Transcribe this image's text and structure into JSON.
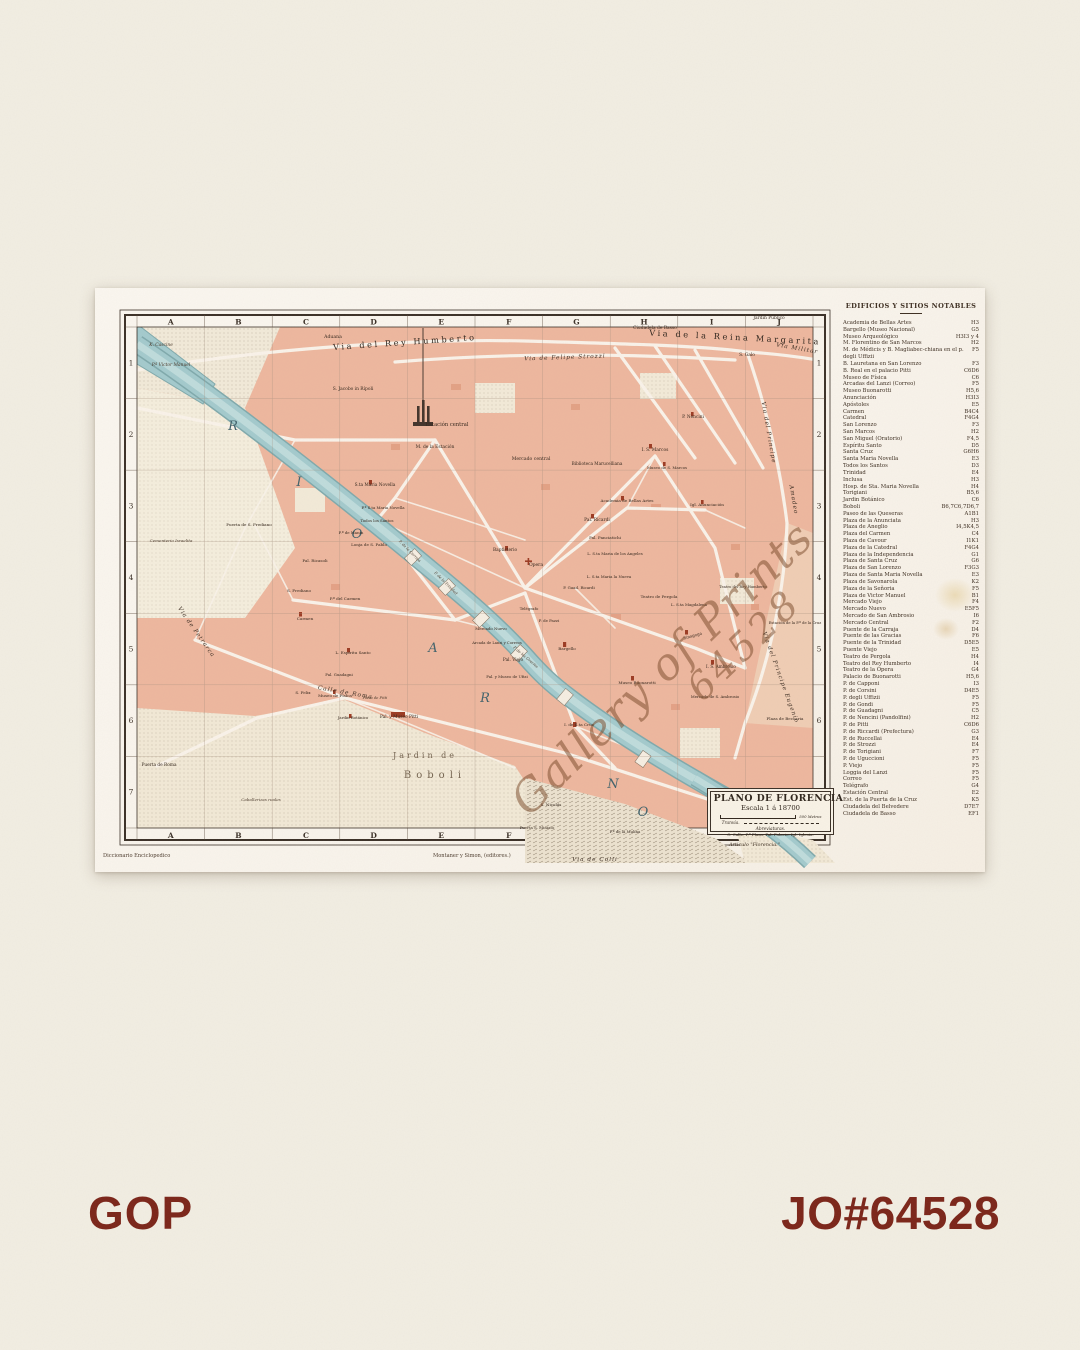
{
  "page": {
    "background_color": "#f2eee3",
    "accent_color": "#7b2418",
    "brand": "GOP",
    "job_number": "JO#64528"
  },
  "map": {
    "title": "PLANO DE FLORENCIA",
    "scale_label": "Escala 1 á 18700",
    "scale_bar_label": "500 Metros",
    "tram_label": "Tranvía.",
    "abbreviations_title": "Abreviaturas.",
    "abbreviations_text": "C. Calle. P.ª Plaza. Pal. Palacio. Igl. Iglesia.",
    "article_note": "Articulo \"Florencia.\"",
    "credits": {
      "left": "Diccionario Enciclopedico",
      "center": "Montaner y Simon, (editores.)"
    },
    "watermark": {
      "line1": "Gallery of Prints",
      "line2": "64528",
      "color": "#79482 8"
    },
    "colors": {
      "city_block": "#eeb79e",
      "block_accent": "#e09a7c",
      "river": "#a3cacd",
      "river_edge": "#7fa9ac",
      "park_cream": "#f3ead8",
      "landmark_red": "#9c3a22",
      "paper": "#faf5ee"
    },
    "grid": {
      "top_columns": [
        "A",
        "B",
        "C",
        "D",
        "E",
        "F",
        "G",
        "H",
        "I",
        "J"
      ],
      "bottom_columns": [
        "A",
        "B",
        "C",
        "D",
        "E",
        "F"
      ],
      "left_rows": [
        "1",
        "2",
        "3",
        "4",
        "5",
        "6",
        "7"
      ],
      "right_rows": [
        "1",
        "2",
        "3",
        "4",
        "5",
        "6",
        "7"
      ]
    },
    "labels": [
      {
        "t": "Via del Rey Humberto",
        "x": 310,
        "y": 57,
        "c": "bst",
        "r": -4
      },
      {
        "t": "Via de la Reina Margarita",
        "x": 640,
        "y": 52,
        "c": "bst",
        "r": 3
      },
      {
        "t": "Via de Felipe Strozzi",
        "x": 470,
        "y": 71,
        "c": "st",
        "r": -2
      },
      {
        "t": "Via Militar",
        "x": 702,
        "y": 62,
        "c": "st",
        "r": 10
      },
      {
        "t": "Via del Principe",
        "x": 672,
        "y": 145,
        "c": "st",
        "r": 80
      },
      {
        "t": "Amadeo",
        "x": 697,
        "y": 212,
        "c": "st",
        "r": 80
      },
      {
        "t": "Via del Principe Eugenio",
        "x": 684,
        "y": 390,
        "c": "st",
        "r": 70
      },
      {
        "t": "Via de Petrarca",
        "x": 100,
        "y": 345,
        "c": "st",
        "r": 55
      },
      {
        "t": "Calle de Roma",
        "x": 250,
        "y": 406,
        "c": "st",
        "r": 10
      },
      {
        "t": "Via de Colli",
        "x": 500,
        "y": 573,
        "c": "st"
      },
      {
        "t": "R",
        "x": 138,
        "y": 142,
        "c": "riv"
      },
      {
        "t": "I",
        "x": 204,
        "y": 198,
        "c": "riv"
      },
      {
        "t": "O",
        "x": 262,
        "y": 250,
        "c": "riv"
      },
      {
        "t": "A",
        "x": 338,
        "y": 364,
        "c": "riv"
      },
      {
        "t": "R",
        "x": 390,
        "y": 414,
        "c": "riv"
      },
      {
        "t": "N",
        "x": 518,
        "y": 500,
        "c": "riv"
      },
      {
        "t": "O",
        "x": 548,
        "y": 528,
        "c": "riv"
      },
      {
        "t": "Jardin de",
        "x": 330,
        "y": 470,
        "c": "ar"
      },
      {
        "t": "Boboli",
        "x": 340,
        "y": 490,
        "c": "ar2"
      },
      {
        "t": "K. Cascine",
        "x": 66,
        "y": 58,
        "c": "pli"
      },
      {
        "t": "P.ª Victor Manuel",
        "x": 76,
        "y": 78,
        "c": "pli",
        "s": 4.4
      },
      {
        "t": "Aduana",
        "x": 238,
        "y": 50,
        "c": "pl"
      },
      {
        "t": "Ciudadela de Basso",
        "x": 560,
        "y": 41,
        "c": "pl",
        "s": 4.4
      },
      {
        "t": "Jardin Público",
        "x": 674,
        "y": 31,
        "c": "pl",
        "s": 4.4
      },
      {
        "t": "S. Galo",
        "x": 652,
        "y": 68,
        "c": "pl",
        "s": 4.4
      },
      {
        "t": "S. Jacobo in Rípoli",
        "x": 258,
        "y": 102,
        "c": "pl",
        "s": 4.4
      },
      {
        "t": "Estación central",
        "x": 352,
        "y": 138,
        "c": "pl",
        "s": 5.2
      },
      {
        "t": "M. de la Estación",
        "x": 340,
        "y": 160,
        "c": "pl",
        "s": 4.4
      },
      {
        "t": "Mercado central",
        "x": 436,
        "y": 172,
        "c": "pl"
      },
      {
        "t": "Biblioteca Marucelliana",
        "x": 502,
        "y": 177,
        "c": "pl",
        "s": 4.2
      },
      {
        "t": "I. S. Marcos",
        "x": 560,
        "y": 163,
        "c": "pl",
        "s": 4.4
      },
      {
        "t": "Museo de S. Marcos",
        "x": 572,
        "y": 181,
        "c": "pl",
        "s": 3.9
      },
      {
        "t": "P. Nencini",
        "x": 598,
        "y": 130,
        "c": "pl",
        "s": 4.3
      },
      {
        "t": "Academia de Bellas Artes",
        "x": 532,
        "y": 214,
        "c": "pl",
        "s": 4.1
      },
      {
        "t": "Igl. Anunciación",
        "x": 612,
        "y": 218,
        "c": "pl",
        "s": 4.1
      },
      {
        "t": "Pal. Ricardi",
        "x": 502,
        "y": 233,
        "c": "pl",
        "s": 4.4
      },
      {
        "t": "Pal. Panciatichi",
        "x": 510,
        "y": 251,
        "c": "pl",
        "s": 4.1
      },
      {
        "t": "S.ta Maria Novella",
        "x": 280,
        "y": 198,
        "c": "pl",
        "s": 4.3
      },
      {
        "t": "P.ª S.ta Maria Novella",
        "x": 288,
        "y": 221,
        "c": "pl",
        "s": 3.9
      },
      {
        "t": "Todos los Santos",
        "x": 282,
        "y": 234,
        "c": "pl",
        "s": 3.9
      },
      {
        "t": "Lonja de S. Pablo",
        "x": 274,
        "y": 258,
        "c": "pl",
        "s": 4.1
      },
      {
        "t": "P.ª de Manin",
        "x": 256,
        "y": 246,
        "c": "pl",
        "s": 3.9
      },
      {
        "t": "Puerta de S. Frediano",
        "x": 154,
        "y": 238,
        "c": "pl",
        "s": 4.1
      },
      {
        "t": "Cementerio Israelita",
        "x": 76,
        "y": 254,
        "c": "pli",
        "s": 4.1
      },
      {
        "t": "Pal. Ricasoli",
        "x": 220,
        "y": 274,
        "c": "pl",
        "s": 4.1
      },
      {
        "t": "S. Frediano",
        "x": 204,
        "y": 304,
        "c": "pl",
        "s": 4.1
      },
      {
        "t": "P.ª del Carmen",
        "x": 250,
        "y": 312,
        "c": "pl",
        "s": 4.1
      },
      {
        "t": "Carmen",
        "x": 210,
        "y": 332,
        "c": "pl",
        "s": 4.1
      },
      {
        "t": "Baptisterio",
        "x": 410,
        "y": 263,
        "c": "pl",
        "s": 4.3
      },
      {
        "t": "Opera",
        "x": 441,
        "y": 278,
        "c": "pl",
        "s": 4.5
      },
      {
        "t": "L. S.ta Maria de los Angeles",
        "x": 520,
        "y": 267,
        "c": "pl",
        "s": 3.9
      },
      {
        "t": "L. S.ta Maria la Nueva",
        "x": 514,
        "y": 290,
        "c": "pl",
        "s": 3.9
      },
      {
        "t": "P. Guad. Ricardi",
        "x": 484,
        "y": 301,
        "c": "pl",
        "s": 3.9
      },
      {
        "t": "Teatro de Pergola",
        "x": 564,
        "y": 310,
        "c": "pl",
        "s": 4.1
      },
      {
        "t": "Telégrafo",
        "x": 434,
        "y": 322,
        "c": "pl",
        "s": 3.9
      },
      {
        "t": "P. de Pazzi",
        "x": 454,
        "y": 334,
        "c": "pl",
        "s": 3.9
      },
      {
        "t": "Bargello",
        "x": 472,
        "y": 362,
        "c": "pl",
        "s": 4.1
      },
      {
        "t": "Pal. Viejo",
        "x": 418,
        "y": 373,
        "c": "pl",
        "s": 4.3
      },
      {
        "t": "Arcada de Lanzi y Correos",
        "x": 402,
        "y": 356,
        "c": "pl",
        "s": 3.7
      },
      {
        "t": "Pal. y Museo de Ufizi",
        "x": 412,
        "y": 390,
        "c": "pl",
        "s": 3.9
      },
      {
        "t": "Mercado Nuevo",
        "x": 396,
        "y": 342,
        "c": "pl",
        "s": 3.9
      },
      {
        "t": "Museo Buonarotti",
        "x": 542,
        "y": 396,
        "c": "pl",
        "s": 4.1
      },
      {
        "t": "I. S. Ambrosio",
        "x": 626,
        "y": 380,
        "c": "pl",
        "s": 4.2
      },
      {
        "t": "Sinagoga",
        "x": 598,
        "y": 349,
        "c": "pl",
        "s": 4,
        "r": -15
      },
      {
        "t": "L. S.ta Magdalena",
        "x": 594,
        "y": 318,
        "c": "pl",
        "s": 3.9
      },
      {
        "t": "Teatro del Rey Humberto",
        "x": 648,
        "y": 300,
        "c": "pl",
        "s": 3.7
      },
      {
        "t": "Mercado de S. Ambrosio",
        "x": 620,
        "y": 410,
        "c": "pl",
        "s": 3.9
      },
      {
        "t": "Plaza de Beccaria",
        "x": 690,
        "y": 432,
        "c": "pl",
        "s": 4.1
      },
      {
        "t": "Estación de la P.ª de la Cruz",
        "x": 700,
        "y": 336,
        "c": "pl",
        "s": 3.7
      },
      {
        "t": "I. de S.ta Cruz",
        "x": 484,
        "y": 438,
        "c": "pl",
        "s": 4.1
      },
      {
        "t": "S. Nicolás",
        "x": 456,
        "y": 518,
        "c": "pl",
        "s": 4.1
      },
      {
        "t": "Puerta S. Miniato",
        "x": 442,
        "y": 541,
        "c": "pl",
        "s": 3.9
      },
      {
        "t": "P.ª de la Mulina",
        "x": 530,
        "y": 545,
        "c": "pl",
        "s": 3.9
      },
      {
        "t": "Museo de Física",
        "x": 240,
        "y": 409,
        "c": "pl",
        "s": 4.1
      },
      {
        "t": "Jardin Botánico",
        "x": 258,
        "y": 431,
        "c": "pl",
        "s": 3.9
      },
      {
        "t": "Pal. y Museo Pitti",
        "x": 304,
        "y": 430,
        "c": "pl",
        "s": 4.3
      },
      {
        "t": "Plaza de Pitti",
        "x": 280,
        "y": 411,
        "c": "pli",
        "s": 3.7
      },
      {
        "t": "S. Felix",
        "x": 208,
        "y": 406,
        "c": "pl",
        "s": 4.1
      },
      {
        "t": "L. Espíritu Santo",
        "x": 258,
        "y": 366,
        "c": "pl",
        "s": 4.1
      },
      {
        "t": "Pal. Guadagni",
        "x": 244,
        "y": 388,
        "c": "pl",
        "s": 3.9
      },
      {
        "t": "Puerta de Roma",
        "x": 64,
        "y": 478,
        "c": "pl",
        "s": 4.3
      },
      {
        "t": "Caballerizas reales",
        "x": 166,
        "y": 513,
        "c": "pli",
        "s": 4.1
      },
      {
        "t": "P. de la Carraja",
        "x": 314,
        "y": 264,
        "c": "sm",
        "r": 45
      },
      {
        "t": "P. de la Trinidad",
        "x": 350,
        "y": 296,
        "c": "sm",
        "r": 45
      },
      {
        "t": "P. de las Gracias",
        "x": 430,
        "y": 370,
        "c": "sm",
        "r": 40
      }
    ],
    "legend": {
      "title": "EDIFICIOS Y SITIOS NOTABLES",
      "entries": [
        {
          "name": "Academia de Bellas Artes",
          "ref": "H3"
        },
        {
          "name": "Bargello (Museo Nacional)",
          "ref": "G5"
        },
        {
          "name": "Museo Arqueológico",
          "ref": "H3I3 y 4"
        },
        {
          "name": "M. Florentino de San Marcos",
          "ref": "H2"
        },
        {
          "name": "M. de Médicis y B. Magliabec-chiana en el p. degli Uffizii",
          "ref": "F5"
        },
        {
          "name": "B. Lauretana en San Lorenzo",
          "ref": "F3"
        },
        {
          "name": "B. Real en el palacio Pitti",
          "ref": "C6D6"
        },
        {
          "name": "Museo de Física",
          "ref": "C6"
        },
        {
          "name": "Arcadas del Lanzi (Correo)",
          "ref": "F5"
        },
        {
          "name": "Museo Buonarotti",
          "ref": "H5,6"
        },
        {
          "name": "Anunciación",
          "ref": "H3I3"
        },
        {
          "name": "Apóstoles",
          "ref": "E5"
        },
        {
          "name": "Carmen",
          "ref": "B4C4"
        },
        {
          "name": "Catedral",
          "ref": "F4G4"
        },
        {
          "name": "San Lorenzo",
          "ref": "F3"
        },
        {
          "name": "San Marcos",
          "ref": "H2"
        },
        {
          "name": "San Miguel (Oratorio)",
          "ref": "F4,5"
        },
        {
          "name": "Espíritu Santo",
          "ref": "D5"
        },
        {
          "name": "Santa Cruz",
          "ref": "G6H6"
        },
        {
          "name": "Santa Maria Novella",
          "ref": "E3"
        },
        {
          "name": "Todos los Santos",
          "ref": "D3"
        },
        {
          "name": "Trinidad",
          "ref": "E4"
        },
        {
          "name": "Inclusa",
          "ref": "H3"
        },
        {
          "name": "Hosp. de Sta. Maria Novella",
          "ref": "H4"
        },
        {
          "name": "Torigiani",
          "ref": "B5,6"
        },
        {
          "name": "Jardin Botánico",
          "ref": "C6"
        },
        {
          "name": "Boboli",
          "ref": "B6,7C6,7D6,7"
        },
        {
          "name": "Paseo de las Queseras",
          "ref": "A1B1"
        },
        {
          "name": "Plaza de la Anunciata",
          "ref": "H3"
        },
        {
          "name": "Plaza de Aneglio",
          "ref": "I4,5K4,5"
        },
        {
          "name": "Plaza del Carmen",
          "ref": "C4"
        },
        {
          "name": "Plaza de Cavour",
          "ref": "I1K1"
        },
        {
          "name": "Plaza de la Catedral",
          "ref": "F4G4"
        },
        {
          "name": "Plaza de la Independencia",
          "ref": "G1"
        },
        {
          "name": "Plaza de Santa Cruz",
          "ref": "G6"
        },
        {
          "name": "Plaza de San Lorenzo",
          "ref": "F3G3"
        },
        {
          "name": "Plaza de Santa Maria Novella",
          "ref": "E3"
        },
        {
          "name": "Plaza de Savonarola",
          "ref": "K2"
        },
        {
          "name": "Plaza de la Señoria",
          "ref": "F5"
        },
        {
          "name": "Plaza de Victor Manuel",
          "ref": "B1"
        },
        {
          "name": "Mercado Viejo",
          "ref": "F4"
        },
        {
          "name": "Mercado Nuevo",
          "ref": "E5F5"
        },
        {
          "name": "Mercado de San Ambrosio",
          "ref": "I6"
        },
        {
          "name": "Mercado Central",
          "ref": "F2"
        },
        {
          "name": "Puente de la Carraja",
          "ref": "D4"
        },
        {
          "name": "Puente de las Gracias",
          "ref": "F6"
        },
        {
          "name": "Puente de la Trinidad",
          "ref": "D5E5"
        },
        {
          "name": "Puente Viejo",
          "ref": "E5"
        },
        {
          "name": "Teatro de Pergola",
          "ref": "H4"
        },
        {
          "name": "Teatro del Rey Humberto",
          "ref": "I4"
        },
        {
          "name": "Teatro de la Ópera",
          "ref": "G4"
        },
        {
          "name": "Palacio de Buonarotti",
          "ref": "H5,6"
        },
        {
          "name": "P. de Capponi",
          "ref": "I3"
        },
        {
          "name": "P. de Corsini",
          "ref": "D4E5"
        },
        {
          "name": "P. degli Uffizii",
          "ref": "F5"
        },
        {
          "name": "P. de Gondi",
          "ref": "F5"
        },
        {
          "name": "P. de Guadagni",
          "ref": "C5"
        },
        {
          "name": "P. de Nencini (Pandolfini)",
          "ref": "H2"
        },
        {
          "name": "P. de Pitti",
          "ref": "C6D6"
        },
        {
          "name": "P. de Riccardi (Prefectura)",
          "ref": "G3"
        },
        {
          "name": "P. de Ruccellai",
          "ref": "E4"
        },
        {
          "name": "P. de Strozzi",
          "ref": "E4"
        },
        {
          "name": "P. de Torigiani",
          "ref": "F7"
        },
        {
          "name": "P. de Uguccioni",
          "ref": "F5"
        },
        {
          "name": "P. Viejo",
          "ref": "F5"
        },
        {
          "name": "Loggia del Lanzi",
          "ref": "F5"
        },
        {
          "name": "Correo",
          "ref": "F5"
        },
        {
          "name": "Telégrafo",
          "ref": "G4"
        },
        {
          "name": "Estación Central",
          "ref": "E2"
        },
        {
          "name": "Est. de la Puerta de la Cruz",
          "ref": "K5"
        },
        {
          "name": "Ciudadela del Belvedere",
          "ref": "D7E7"
        },
        {
          "name": "Ciudadela de Basso",
          "ref": "EF1"
        }
      ]
    }
  }
}
